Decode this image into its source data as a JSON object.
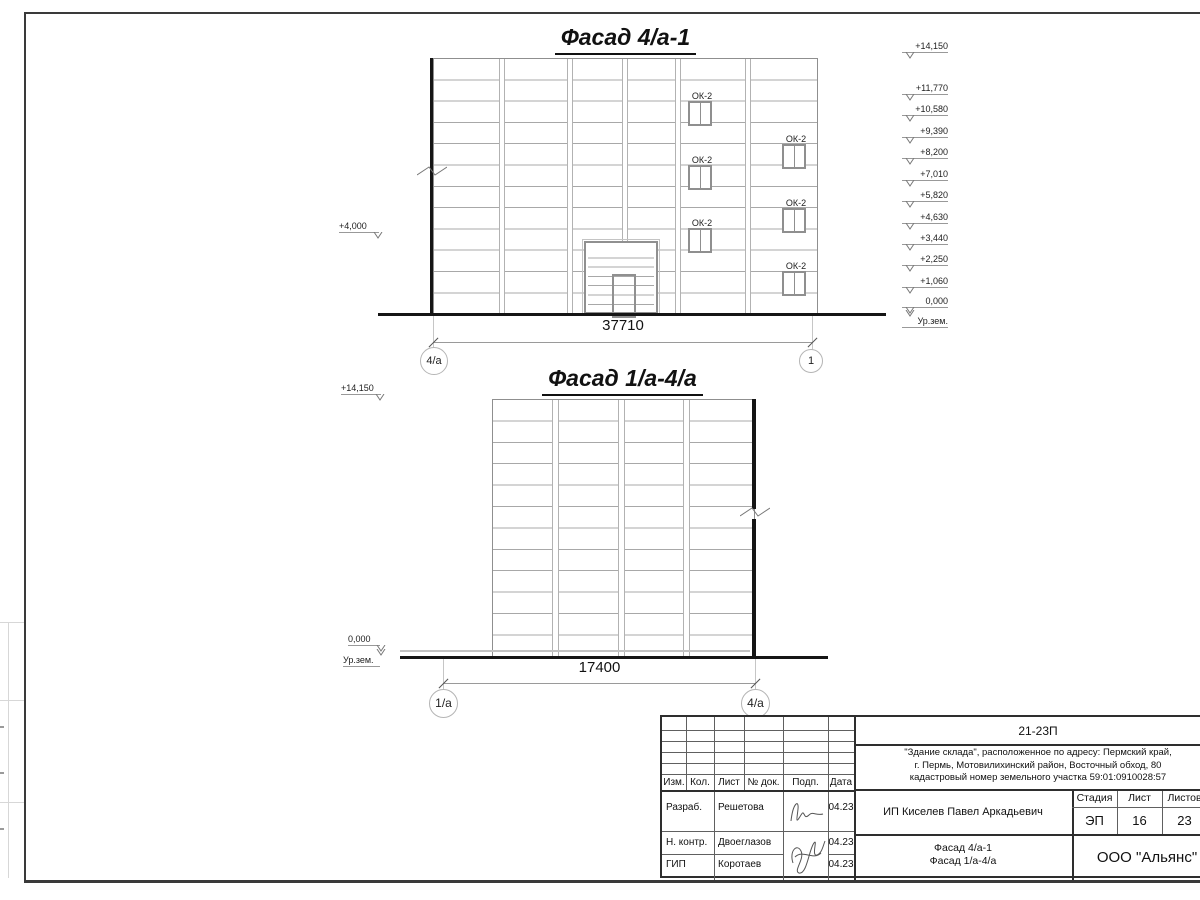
{
  "facade1": {
    "title": "Фасад 4/а-1",
    "dimension": "37710",
    "axis_left": "4/а",
    "axis_right": "1",
    "left_level": "+4,000",
    "window_label": "ОК-2",
    "levels": [
      {
        "label": "+14,150",
        "y": 58
      },
      {
        "label": "+11,770",
        "y": 100
      },
      {
        "label": "+10,580",
        "y": 121
      },
      {
        "label": "+9,390",
        "y": 143
      },
      {
        "label": "+8,200",
        "y": 164
      },
      {
        "label": "+7,010",
        "y": 186
      },
      {
        "label": "+5,820",
        "y": 207
      },
      {
        "label": "+4,630",
        "y": 229
      },
      {
        "label": "+3,440",
        "y": 250
      },
      {
        "label": "+2,250",
        "y": 271
      },
      {
        "label": "+1,060",
        "y": 293
      },
      {
        "label": "0,000",
        "y": 313
      },
      {
        "label": "Ур.зем.",
        "y": 313,
        "ground": true
      }
    ],
    "windows": [
      {
        "x": 687,
        "y": 100
      },
      {
        "x": 687,
        "y": 164
      },
      {
        "x": 687,
        "y": 227
      },
      {
        "x": 781,
        "y": 143
      },
      {
        "x": 781,
        "y": 207
      },
      {
        "x": 781,
        "y": 270
      }
    ]
  },
  "facade2": {
    "title": "Фасад 1/а-4/а",
    "dimension": "17400",
    "axis_left": "1/а",
    "axis_right": "4/а",
    "top_level": "+14,150",
    "zero_level": "0,000",
    "ground_label": "Ур.зем."
  },
  "titleblock": {
    "doc_number": "21-23П",
    "description_line1": "\"Здание склада\", расположенное по адресу: Пермский край,",
    "description_line2": "г. Пермь, Мотовилихинский район, Восточный обход, 80",
    "description_line3": "кадастровый номер земельного участка 59:01:0910028:57",
    "client": "ИП Киселев Павел Аркадьевич",
    "stage_header": "Стадия",
    "sheet_header": "Лист",
    "sheets_header": "Листов",
    "stage": "ЭП",
    "sheet_no": "16",
    "sheets_total": "23",
    "content_line1": "Фасад 4/а-1",
    "content_line2": "Фасад 1/а-4/а",
    "company": "ООО \"Альянс\"",
    "col_izm": "Изм.",
    "col_kol": "Кол.",
    "col_list": "Лист",
    "col_doc": "№ док.",
    "col_podp": "Подп.",
    "col_data": "Дата",
    "row1_role": "Разраб.",
    "row1_name": "Решетова",
    "row1_date": "04.23",
    "row2_role": "Н. контр.",
    "row2_name": "Двоеглазов",
    "row2_date": "04.23",
    "row3_role": "ГИП",
    "row3_name": "Коротаев",
    "row3_date": "04.23"
  }
}
